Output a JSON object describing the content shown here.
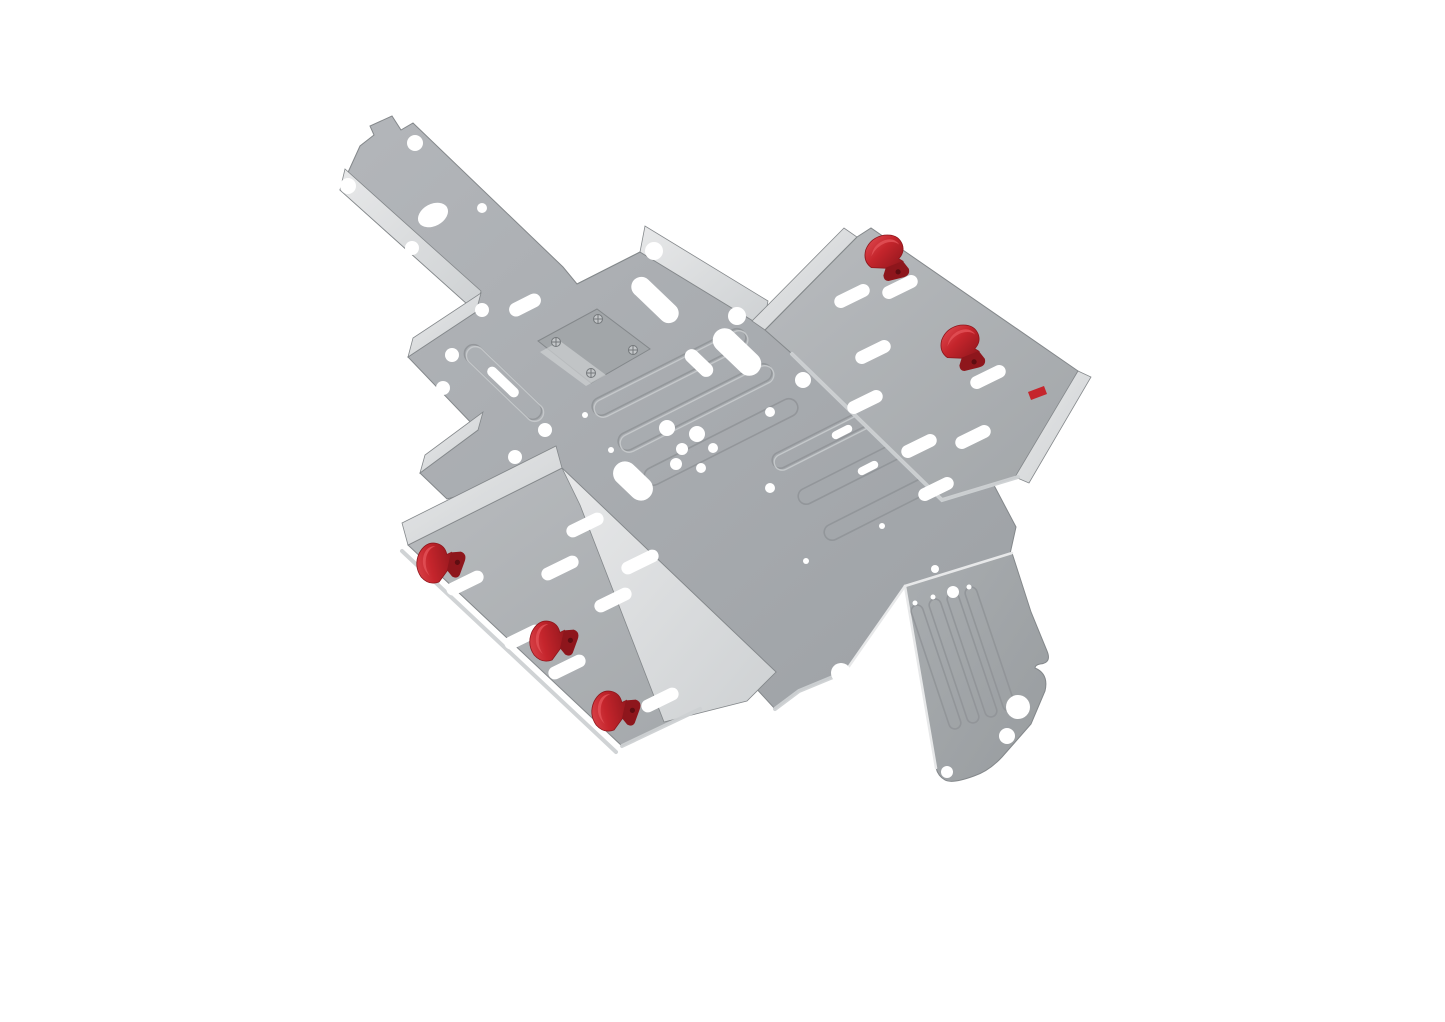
{
  "scene": {
    "subject": "Isometric CAD render of a sheet metal bracket assembly with red retaining clips",
    "background": "#ffffff",
    "clip_count_visible": 5,
    "clip_count_partial": 1,
    "colors": {
      "background": "#ffffff",
      "plate_light": "#b3b6ba",
      "plate_dark": "#9da1a5",
      "wing_light": "#b8bbbe",
      "wing_dark": "#a2a6a9",
      "tail_light": "#a9adb0",
      "tail_dark": "#989c9f",
      "flange_bright": "#e7e8e9",
      "flange_mid": "#ced1d3",
      "edge_dark": "#84888b",
      "rib_line": "#8f9396",
      "rib_highlight": "#c8cbcd",
      "hole": "#ffffff",
      "clip_red": "#c5252c",
      "clip_red_dark": "#8e161c",
      "clip_red_bright": "#e25056",
      "screw": "#74787b",
      "screw_light": "#c3c6c8"
    },
    "parts": [
      {
        "id": "main-plate",
        "label": "perforated base plate with embossed ribs"
      },
      {
        "id": "top-left-arm",
        "label": "long arm with oval cutout and bent flange"
      },
      {
        "id": "right-wing-tray",
        "label": "tilted tray wing, two red clips"
      },
      {
        "id": "left-wing-tray",
        "label": "tilted tray wing, three red clips"
      },
      {
        "id": "tail-flap",
        "label": "tail flap with ribs and scalloped edge"
      },
      {
        "id": "mounting-bracket",
        "label": "small mounting plate with four screws"
      }
    ]
  }
}
